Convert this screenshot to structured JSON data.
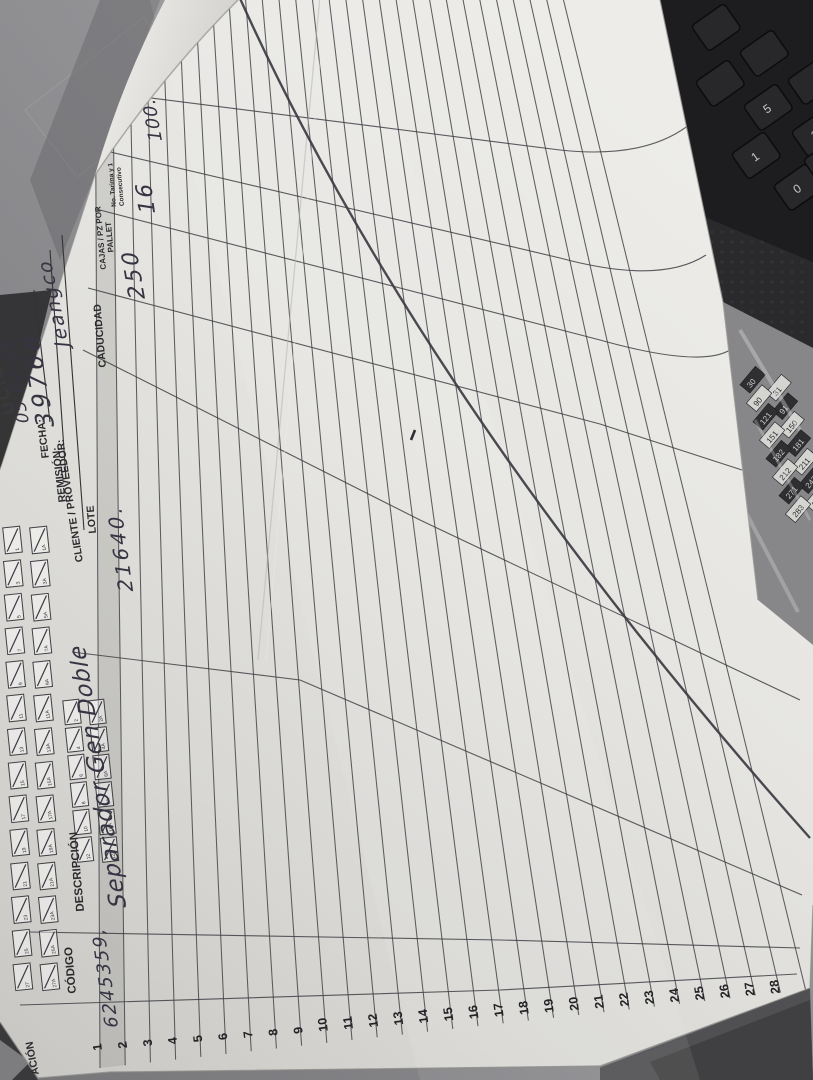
{
  "scene": {
    "description": "Photograph of a paper receiving form lying rotated 90° on a desk"
  },
  "form": {
    "title_partial": "UCIÓN",
    "fields": {
      "fecha_label": "FECHA:",
      "fecha_value": "05-02-25",
      "remision_label": "REMISIÓN:",
      "remision_value": "39768",
      "cliente_label": "CLIENTE / PROVEEDOR:",
      "cliente_value": "Jeangco"
    },
    "table": {
      "headers": {
        "ubicacion_partial": "ACIÓN",
        "codigo": "CÓDIGO",
        "descripcion": "DESCRIPCIÓN",
        "lote": "LOTE",
        "caducidad": "CADUCIDAD",
        "cajas_line1": "CAJAS / PZ POR",
        "cajas_line2": "PALLET",
        "tarima_line1": "No. Tarima y 1",
        "tarima_line2": "Consecutivo"
      },
      "row_numbers": [
        "1",
        "2",
        "3",
        "4",
        "5",
        "6",
        "7",
        "8",
        "9",
        "10",
        "11",
        "12",
        "13",
        "14",
        "15",
        "16",
        "17",
        "18",
        "19",
        "20",
        "21",
        "22",
        "23",
        "24",
        "25",
        "26",
        "27",
        "28"
      ],
      "entries": [
        {
          "row": "1",
          "codigo": "6245359,",
          "descripcion": "Separador Gen Doble",
          "lote": "21640.",
          "caducidad": "",
          "cajas_pz_por_pallet": "250",
          "no_tarima_consecutivo": "16",
          "columna_oculta": "100."
        }
      ]
    },
    "tarima_checkboxes": {
      "strip1_labels": [
        "1",
        "1A",
        "3",
        "3A",
        "5",
        "5A",
        "7",
        "7A",
        "9",
        "9A",
        "11",
        "11A",
        "13",
        "13A",
        "15",
        "15A",
        "17",
        "17A",
        "19",
        "19A",
        "21",
        "21A",
        "23",
        "23A",
        "25",
        "25A",
        "27",
        "27A"
      ],
      "strip2_labels": [
        "2",
        "2A",
        "4",
        "4A",
        "6",
        "6A",
        "8",
        "8A",
        "10",
        "10A",
        "12",
        "12A"
      ]
    },
    "annotations": {
      "strike_through": "long diagonal pen line across empty rows",
      "ink_dot": "small ink mark mid-page"
    }
  },
  "background": {
    "keyboard": {
      "keys": [
        "5",
        "1",
        "2",
        "0"
      ]
    },
    "tag_sheet_numbers": [
      "30",
      "31",
      "90",
      "91",
      "121",
      "150",
      "151",
      "181",
      "182",
      "211",
      "212",
      "242",
      "271",
      "272",
      "283"
    ]
  }
}
